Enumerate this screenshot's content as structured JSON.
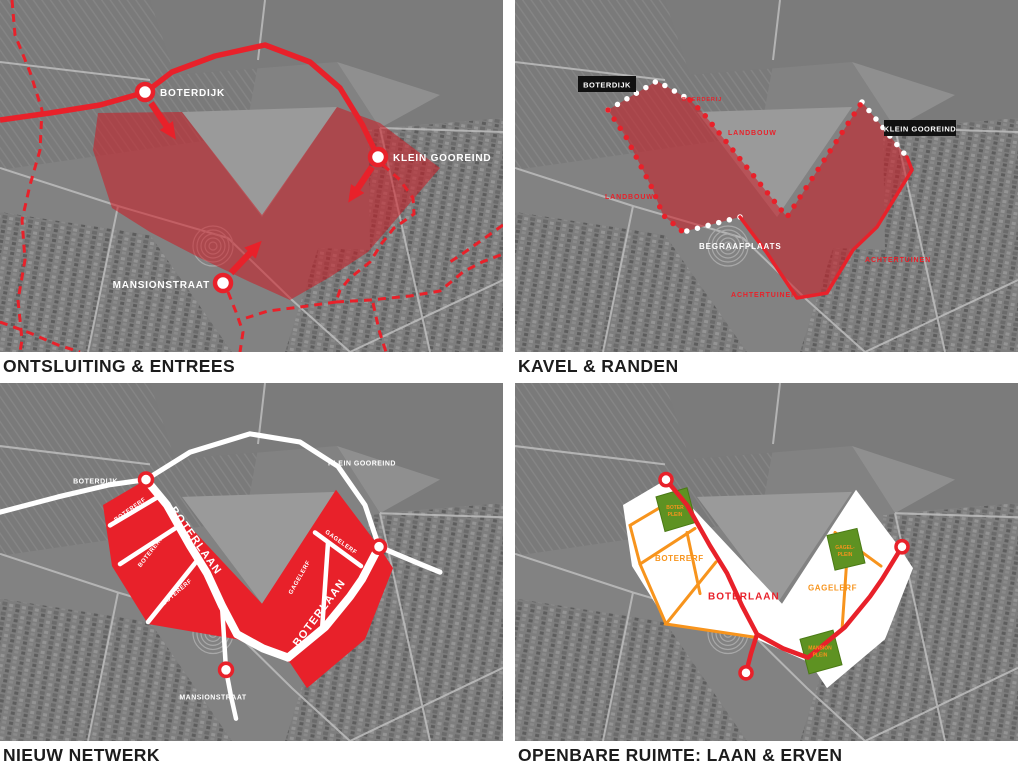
{
  "colors": {
    "accent_red": "#e8212a",
    "overlay_red": "rgba(205,25,35,0.55)",
    "orange": "#f7941d",
    "green": "#5e9222",
    "label_black_box": "#111111",
    "caption_text": "#1c1c1c",
    "photo_gray": "#828282"
  },
  "panels": {
    "ontsluiting": {
      "caption": "ONTSLUITING & ENTREES",
      "labels": {
        "boterdijk": "BOTERDIJK",
        "klein_gooreind": "KLEIN GOOREIND",
        "mansionstraat": "MANSIONSTRAAT"
      }
    },
    "kavel": {
      "caption": "KAVEL & RANDEN",
      "labels": {
        "boterdijk": "BOTERDIJK",
        "klein_gooreind": "KLEIN GOOREIND",
        "boerderij": "BOERDERIJ",
        "landbouw_top": "LANDBOUW",
        "landbouw_left": "LANDBOUW",
        "begraafplaats": "BEGRAAFPLAATS",
        "achtertuinen_right": "ACHTERTUINEN",
        "achtertuinen_bottom": "ACHTERTUINEN"
      }
    },
    "netwerk": {
      "caption": "NIEUW NETWERK",
      "labels": {
        "boterdijk": "BOTERDIJK",
        "klein_gooreind": "KLEIN GOOREIND",
        "mansionstraat": "MANSIONSTRAAT",
        "boterlaan_1": "BOTERLAAN",
        "boterlaan_2": "BOTERLAAN",
        "botererf_1": "BOTERERF",
        "botererf_2": "BOTERERF",
        "botererf_3": "BOTERERF",
        "gagelerf_1": "GAGELERF",
        "gagelerf_2": "GAGELERF"
      }
    },
    "openbare": {
      "caption": "OPENBARE RUIMTE: LAAN & ERVEN",
      "labels": {
        "botererf": "BOTERERF",
        "gagelerf": "GAGELERF",
        "boterlaan": "BOTERLAAN",
        "boter_plein_line1": "BOTER",
        "boter_plein_line2": "PLEIN",
        "gagel_plein_line1": "GAGEL-",
        "gagel_plein_line2": "PLEIN",
        "mansion_plein_line1": "MANSION",
        "mansion_plein_line2": "PLEIN"
      }
    }
  }
}
